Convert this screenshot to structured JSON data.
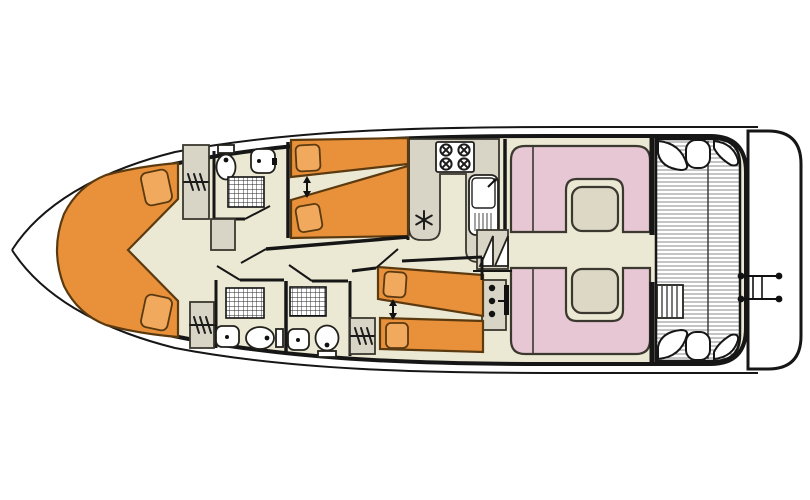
{
  "diagram": {
    "type": "boat-floor-plan",
    "view": "top-down deck plan of a canal cruiser / houseboat, bow pointing left",
    "visible_text": "none"
  },
  "colors": {
    "ink": "#161616",
    "outline": "#3a382f",
    "floor": "#EBE8D3",
    "furniture": "#D8D5C6",
    "bed": "#E8913A",
    "pillow": "#F1A95E",
    "bed_outline": "#5C3A10",
    "seat_pink": "#E6C7D3",
    "table": "#DCD8C5",
    "deck_stripe": "#8A8A8A"
  },
  "rooms": [
    {
      "id": "bow-cabin",
      "label": "V-berth bow cabin",
      "fixtures": [
        "V-shaped double bed",
        "2 pillows"
      ]
    },
    {
      "id": "fwd-bathroom-starboard",
      "label": "Forward bathroom (top)",
      "fixtures": [
        "toilet",
        "washbasin",
        "shower"
      ]
    },
    {
      "id": "cabin-starboard",
      "label": "Starboard twin cabin (top middle)",
      "fixtures": [
        "2 single beds",
        "sliding-bed double arrow",
        "2 pillows"
      ]
    },
    {
      "id": "bathroom-port-1",
      "label": "Port bathroom 1 (bottom left)",
      "fixtures": [
        "shower",
        "washbasin",
        "toilet"
      ]
    },
    {
      "id": "bathroom-port-2",
      "label": "Port bathroom 2 (bottom middle)",
      "fixtures": [
        "shower",
        "washbasin",
        "toilet"
      ]
    },
    {
      "id": "cabin-port",
      "label": "Port twin cabin (bottom middle)",
      "fixtures": [
        "2 single beds",
        "sliding-bed double arrow",
        "2 pillows"
      ]
    },
    {
      "id": "galley",
      "label": "Galley",
      "fixtures": [
        "U-shaped counter",
        "4-burner hob",
        "sink with drainer and faucet",
        "refrigerator (snowflake symbol)"
      ]
    },
    {
      "id": "companionway",
      "label": "Companionway stairs",
      "fixtures": [
        "2 step-triangles"
      ]
    },
    {
      "id": "helm",
      "label": "Inside steering position",
      "fixtures": [
        "instrument console with 3 dials",
        "steering wheel bar"
      ]
    },
    {
      "id": "saloon",
      "label": "Saloon / dinette",
      "fixtures": [
        "2 U-shaped settees",
        "2 tables"
      ]
    },
    {
      "id": "aft-deck",
      "label": "Aft deck",
      "fixtures": [
        "slatted deck planking",
        "4 corner seats",
        "deck steps",
        "boarding ladder"
      ]
    },
    {
      "id": "swim-platform",
      "label": "Stern platform band",
      "fixtures": []
    }
  ],
  "storage": {
    "wardrobes": 3,
    "cupboards": 1,
    "wardrobe_symbol": "hatch-marks",
    "doors": 5
  },
  "symbols": [
    {
      "name": "shower-grid",
      "meaning": "shower tray"
    },
    {
      "name": "snowflake",
      "meaning": "refrigerator"
    },
    {
      "name": "double-arrow",
      "meaning": "beds slide together"
    },
    {
      "name": "hatch-marks",
      "meaning": "wardrobe / hanging locker"
    },
    {
      "name": "triangle-steps",
      "meaning": "companionway stairs"
    },
    {
      "name": "ladder-dots",
      "meaning": "stern boarding ladder"
    }
  ]
}
